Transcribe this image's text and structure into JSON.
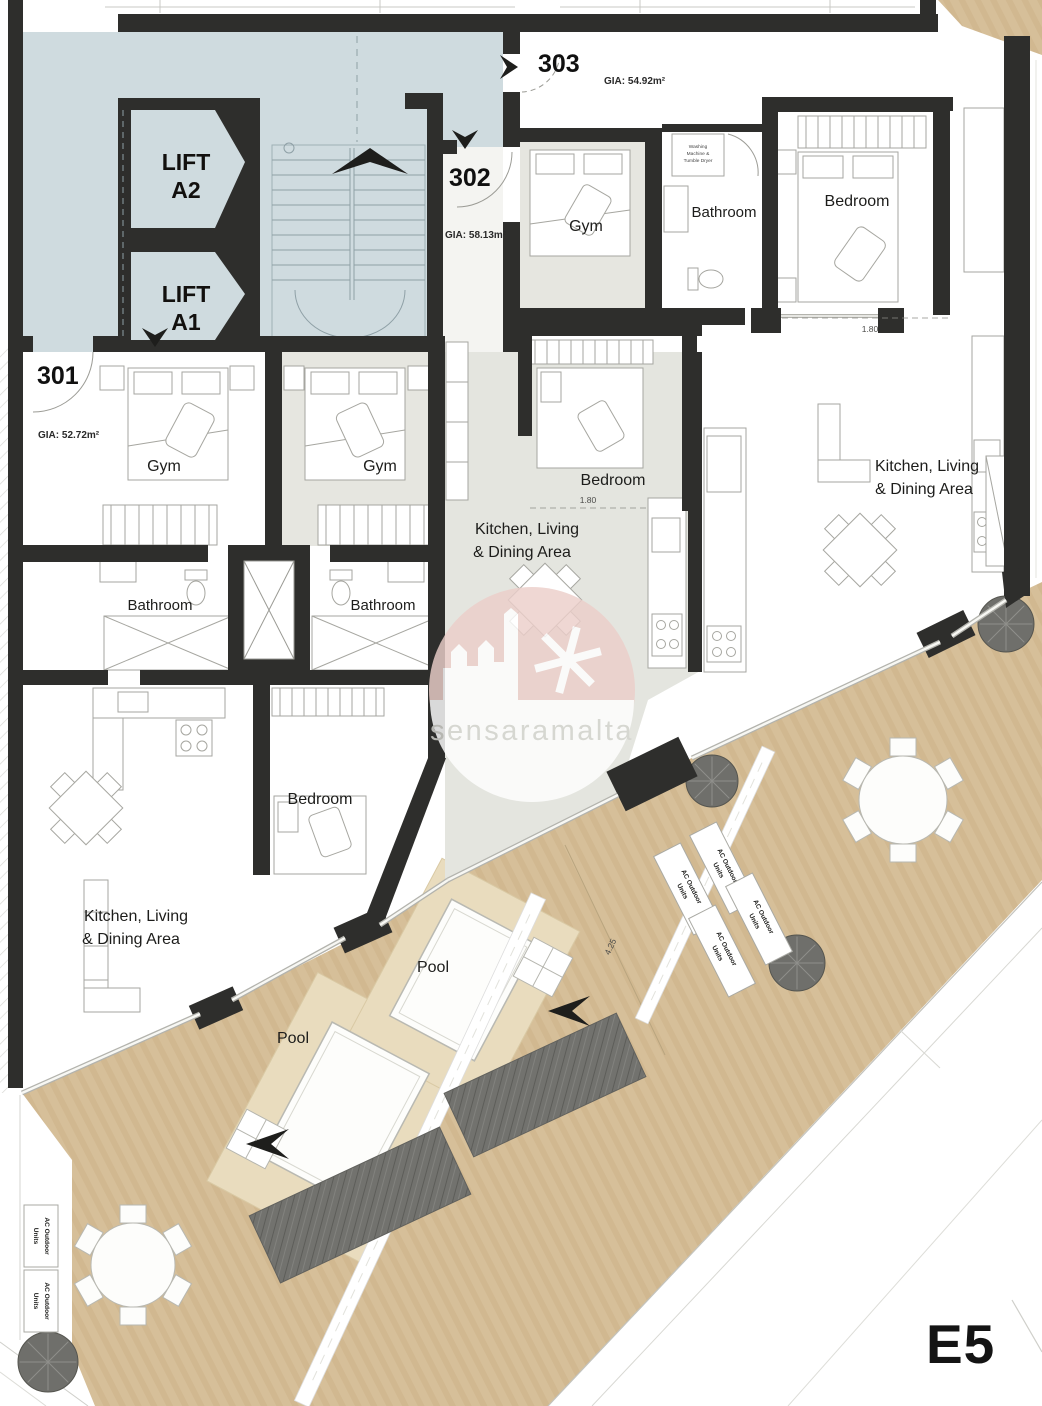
{
  "plan": {
    "code": "E5",
    "watermark": "sensaramalta"
  },
  "units": [
    {
      "number": "301",
      "gia": "GIA: 52.72m²"
    },
    {
      "number": "302",
      "gia": "GIA: 58.13m²"
    },
    {
      "number": "303",
      "gia": "GIA: 54.92m²"
    }
  ],
  "lifts": {
    "a2": {
      "line1": "LIFT",
      "line2": "A2"
    },
    "a1": {
      "line1": "LIFT",
      "line2": "A1"
    }
  },
  "labels": {
    "gym": "Gym",
    "bathroom": "Bathroom",
    "bedroom": "Bedroom",
    "kitchen_line1": "Kitchen, Living",
    "kitchen_line2": "& Dining Area",
    "pool": "Pool",
    "ac_line1": "AC Outdoor",
    "ac_line2": "Units",
    "washer_line1": "Washing",
    "washer_line2": "Machine &",
    "washer_line3": "Tumble Dryer"
  },
  "dimensions": {
    "bedroom_302": "1.80",
    "bedroom_303": "1.80",
    "terrace": "4.25"
  },
  "colors": {
    "wall": "#2e2e2c",
    "lobby": "#cfdbdf",
    "floor_gray": "#e4e5df",
    "terrace": "#d5bd97",
    "pool_deck": "#e9dcbe",
    "planting": "#72726e",
    "watermark_pink": "#eccfca"
  }
}
